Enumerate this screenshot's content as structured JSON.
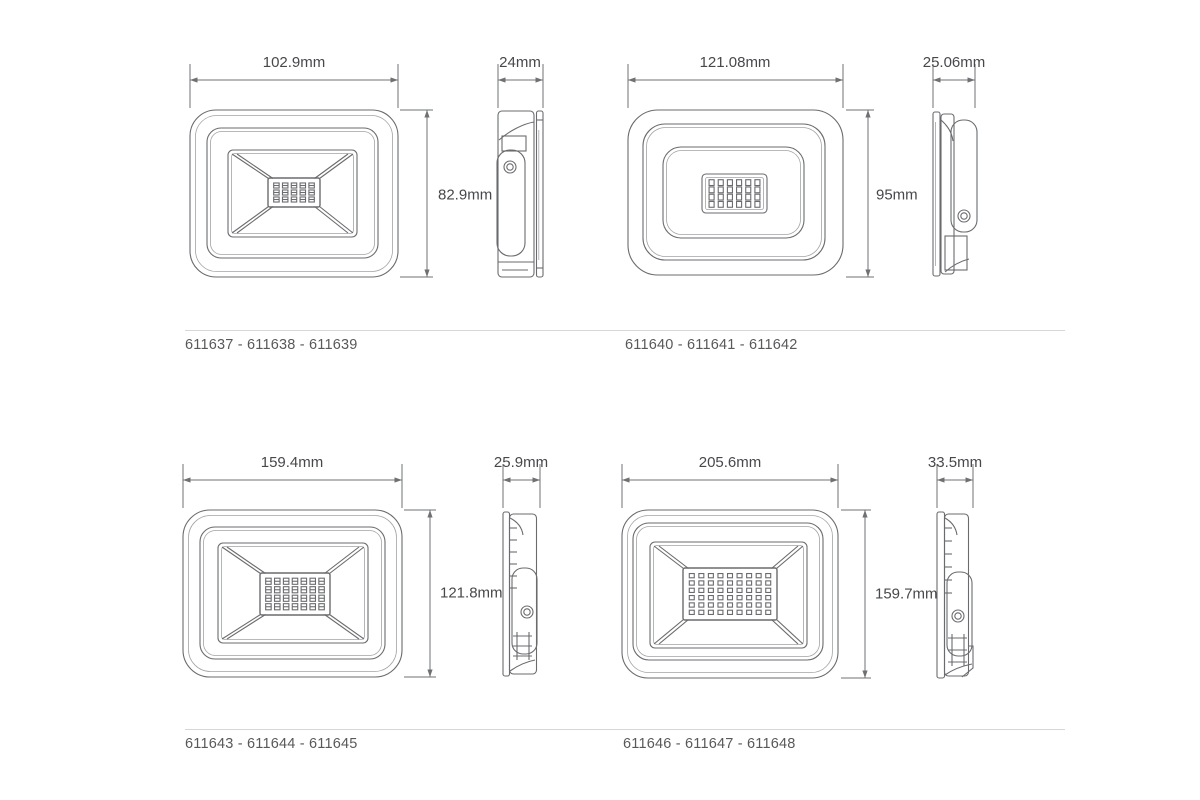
{
  "colors": {
    "line": "#6a6b6e",
    "dim_line": "#6f7073",
    "label_text": "#47484b",
    "code_text": "#58595b",
    "rule": "#d6d7d8",
    "led_fill": "#4d4e52"
  },
  "panels": [
    {
      "name": "top-left",
      "front_width": "102.9mm",
      "front_height": "82.9mm",
      "side_width": "24mm",
      "codes": "611637 - 611638 - 611639",
      "led": {
        "rows": 3,
        "cols": 5
      }
    },
    {
      "name": "top-right",
      "front_width": "121.08mm",
      "front_height": "95mm",
      "side_width": "25.06mm",
      "codes": "611640 - 611641 - 611642",
      "led": {
        "rows": 4,
        "cols": 6
      }
    },
    {
      "name": "bottom-left",
      "front_width": "159.4mm",
      "front_height": "121.8mm",
      "side_width": "25.9mm",
      "codes": "611643 - 611644 - 611645",
      "led": {
        "rows": 4,
        "cols": 7
      }
    },
    {
      "name": "bottom-right",
      "front_width": "205.6mm",
      "front_height": "159.7mm",
      "side_width": "33.5mm",
      "codes": "611646 - 611647 - 611648",
      "led": {
        "rows": 6,
        "cols": 9
      }
    }
  ]
}
